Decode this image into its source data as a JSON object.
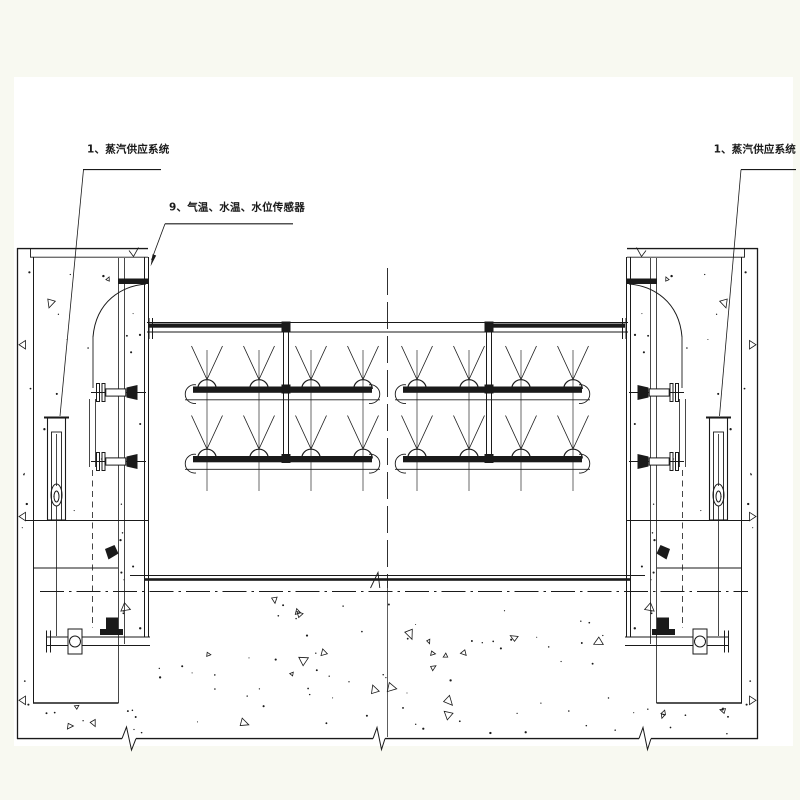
{
  "colors": {
    "background": "#f8f9f1",
    "paper": "#ffffff",
    "ink": "#1a1a1a"
  },
  "labels": {
    "steam_left": "1、蒸汽供应系统",
    "sensors": "9、气温、水温、水位传感器",
    "steam_right": "1、蒸汽供应系统"
  }
}
